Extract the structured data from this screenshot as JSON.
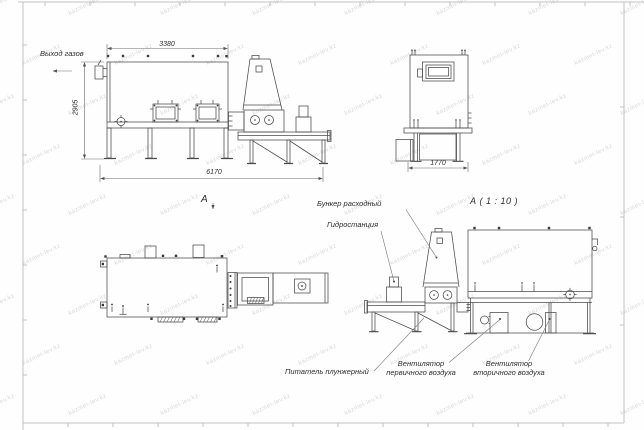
{
  "watermark": {
    "text": "kazmet-lev.kz"
  },
  "colors": {
    "line": "#4a4a4a",
    "dim_line": "#6a6a6a",
    "frame": "#c2c2c2",
    "text": "#2d2d2d",
    "watermark": "#d7d9dc"
  },
  "views": {
    "side": {
      "name_label": "А",
      "gas_outlet_label": "Выход газов",
      "dim_width_top": "3380",
      "dim_height": "2905",
      "dim_length": "6170"
    },
    "rear": {
      "dim_width": "1770"
    },
    "detail": {
      "title": "А ( 1 : 10 )",
      "labels": {
        "hopper": "Бункер расходный",
        "hydro": "Гидростанция",
        "feeder": "Питатель плунжерный",
        "fan_primary": [
          "Вентилятор",
          "первичного воздуха"
        ],
        "fan_secondary": [
          "Вентилятор",
          "вторичного воздуха"
        ]
      }
    }
  }
}
